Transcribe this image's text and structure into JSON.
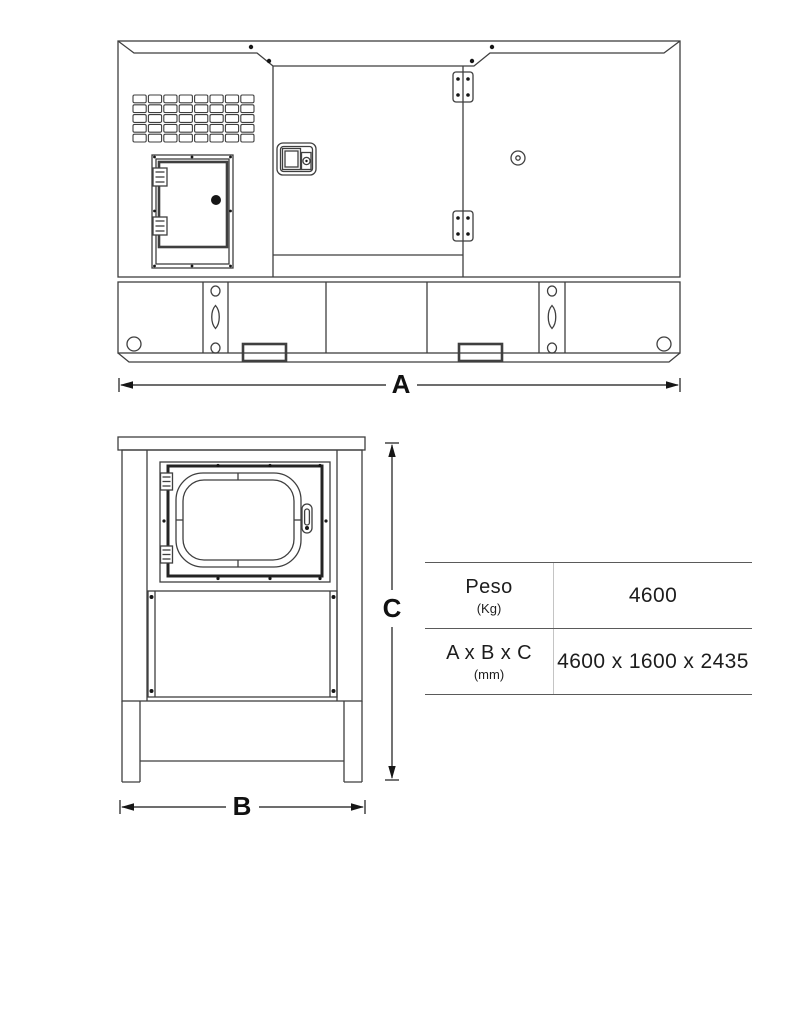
{
  "dimension_labels": {
    "a": "A",
    "b": "B",
    "c": "C"
  },
  "spec_table": {
    "rows": [
      {
        "label": "Peso",
        "unit": "(Kg)",
        "value": "4600"
      },
      {
        "label": "A x B x C",
        "unit": "(mm)",
        "value": "4600 x 1600 x 2435"
      }
    ]
  },
  "colors": {
    "background": "#ffffff",
    "drawing_line": "#3f3f3f",
    "annotation": "#161616",
    "table_rule": "#5a5a5a",
    "table_divider": "#c4c4c4",
    "text": "#1d1d1d"
  }
}
